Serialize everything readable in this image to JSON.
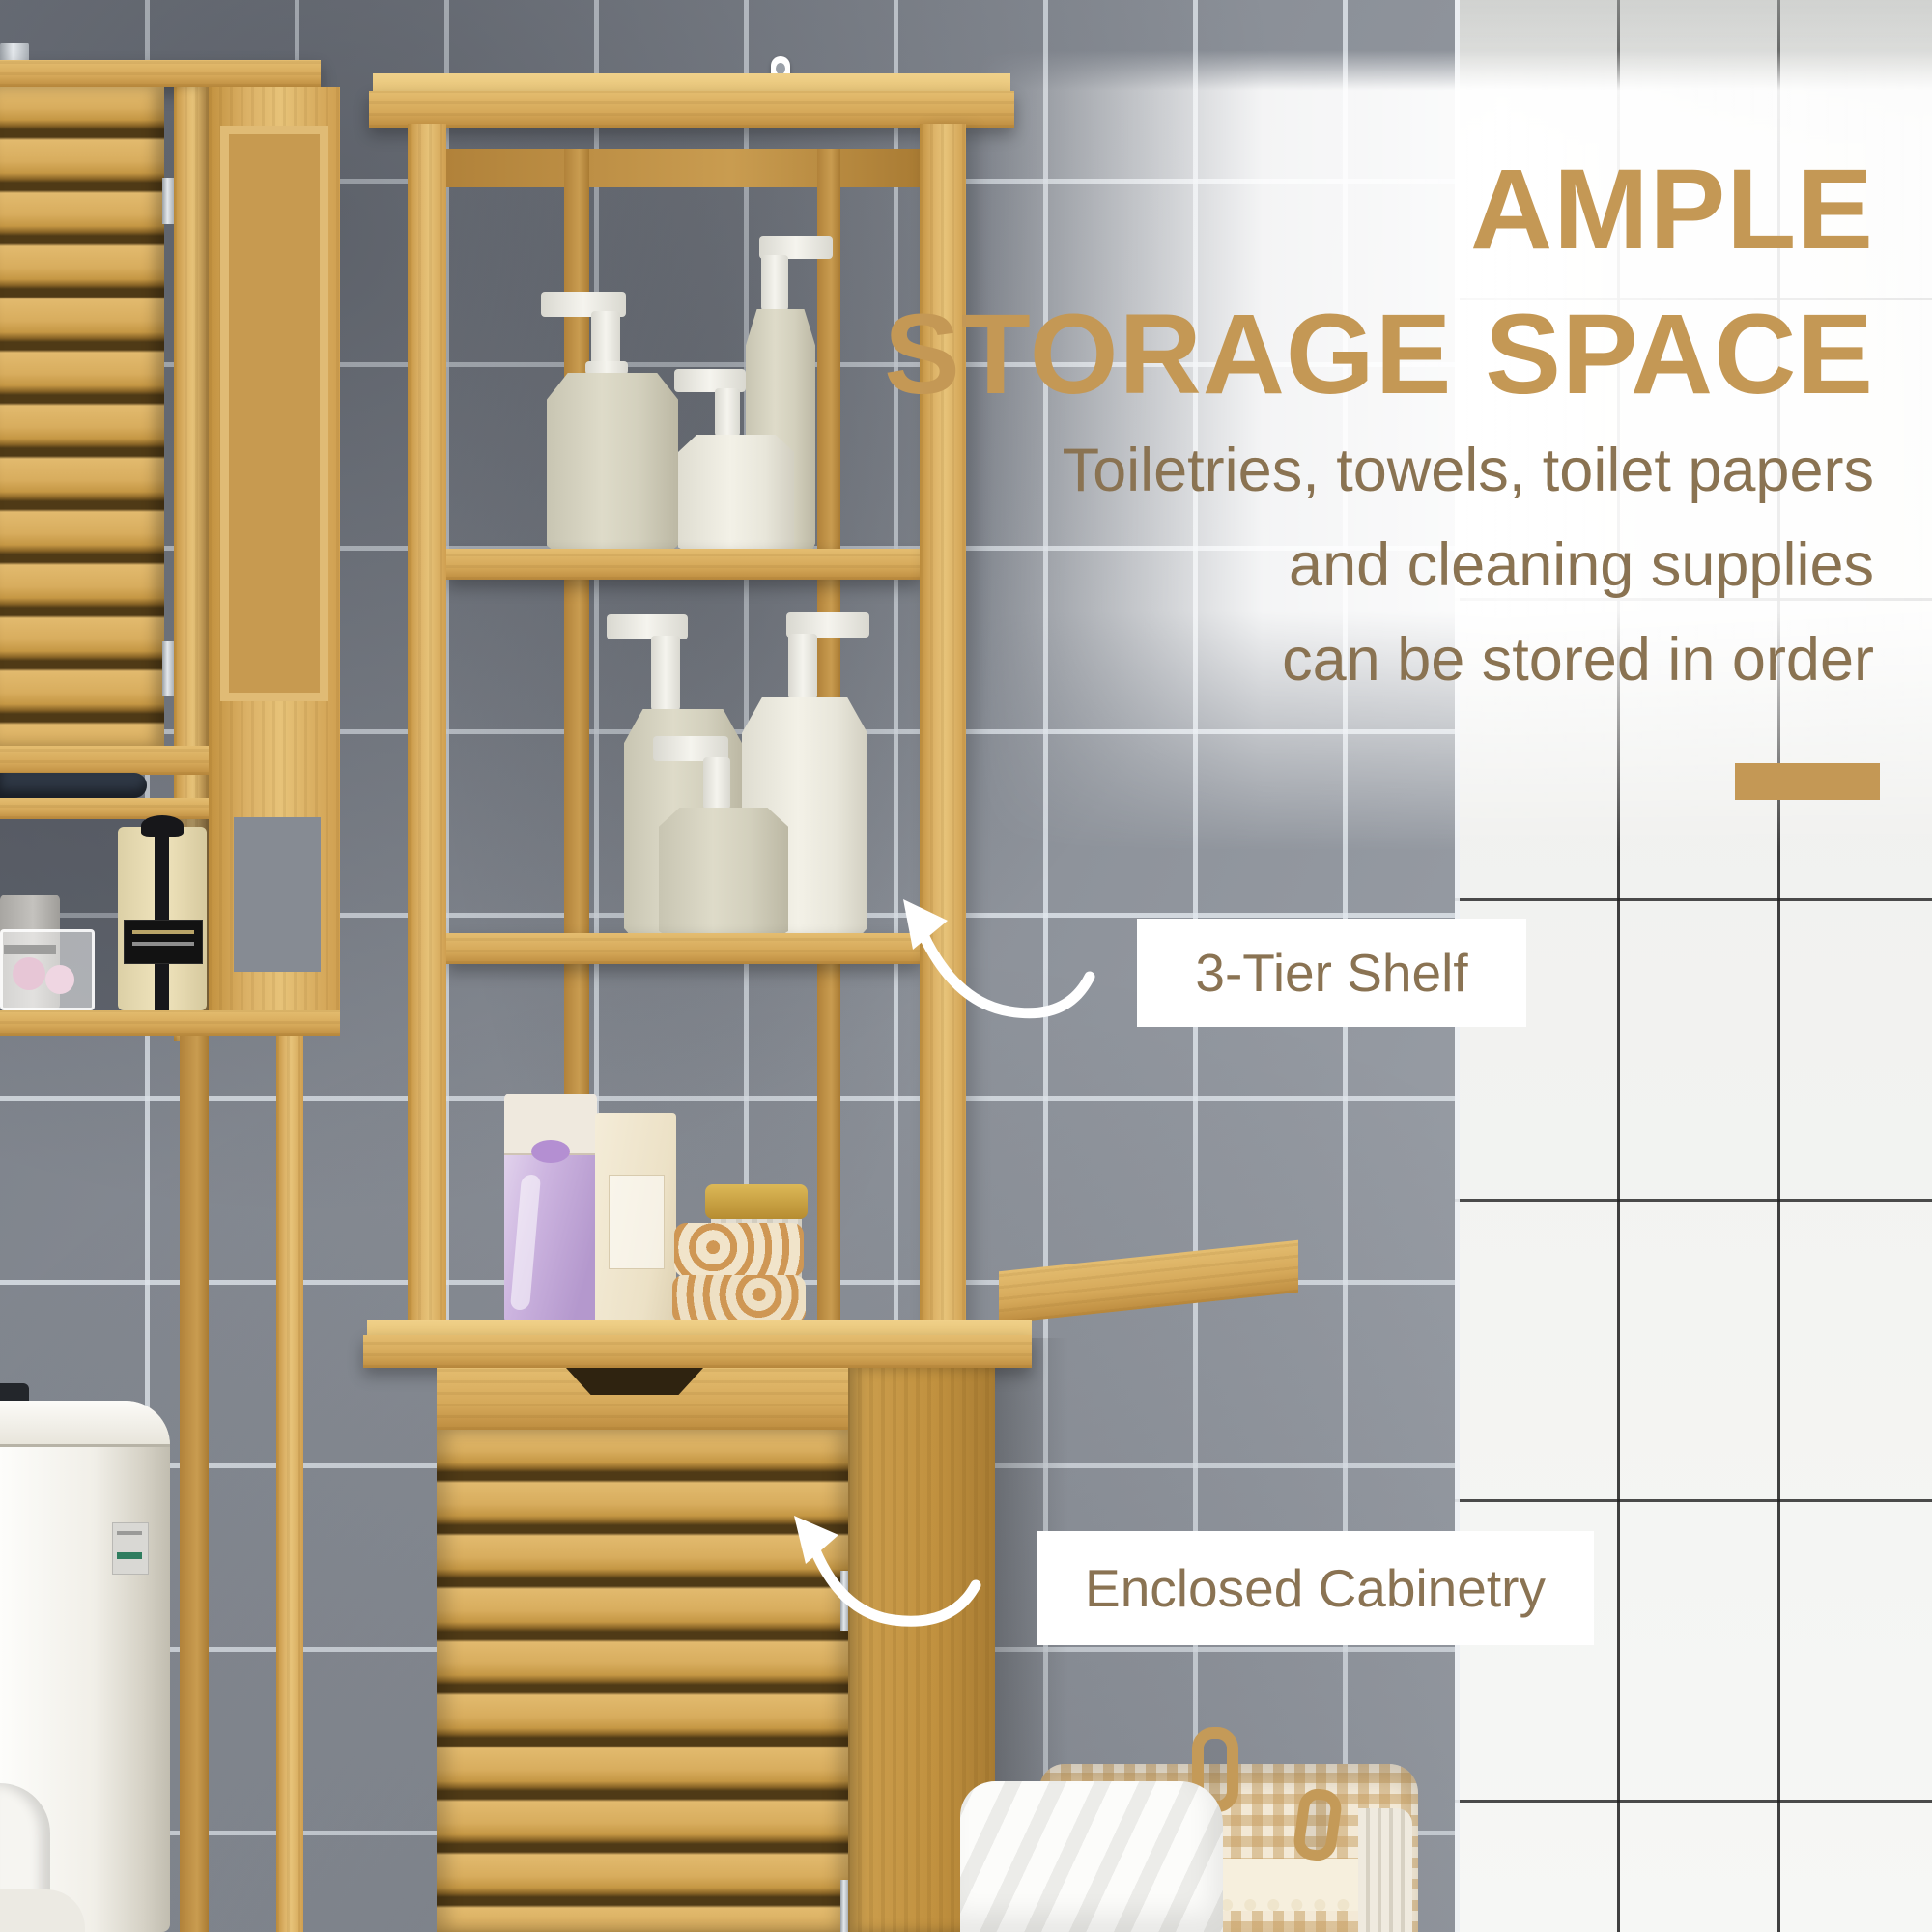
{
  "headline": {
    "line1": "AMPLE",
    "line2": "STORAGE SPACE"
  },
  "subtext": {
    "line1": "Toiletries, towels, toilet papers",
    "line2": "and cleaning supplies",
    "line3": "can be stored in order"
  },
  "callouts": {
    "shelf": {
      "label": "3-Tier Shelf"
    },
    "cabinet": {
      "label": "Enclosed Cabinetry"
    }
  },
  "colors": {
    "accent_gold": "#C49855",
    "text_brown": "#8A7352",
    "callout_text": "#8A7353",
    "callout_bg": "#FFFFFF",
    "arrow_white": "#FFFFFF",
    "bamboo": "#D8AC5E",
    "wall_gray": "#8B9098",
    "white_tile": "#F2F3F1"
  }
}
